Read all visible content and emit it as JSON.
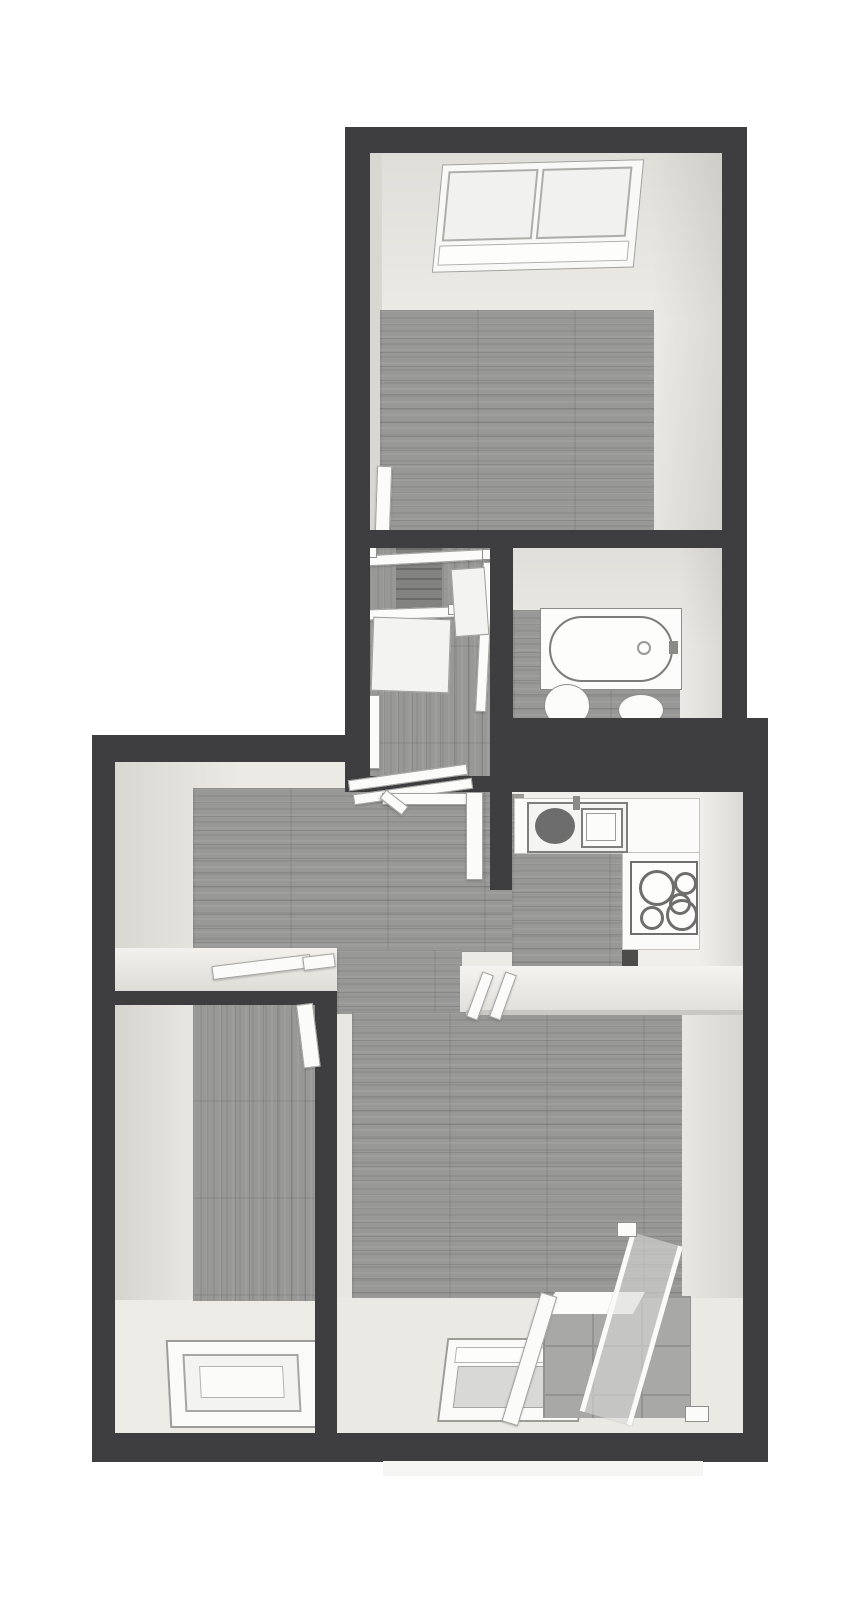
{
  "scene": {
    "type": "3d-floorplan-top-down",
    "description": "Monochrome 3D dollhouse-view floor plan of an attic apartment with sloped ceilings",
    "style": "grayscale render, dark walls, gray wood plank floors, white fixtures"
  },
  "colors": {
    "page-bg": "#ffffff",
    "wall": "#3e3e40",
    "wall-edge": "#4a4a4c",
    "face": "#e7e6e1",
    "face-bright": "#f2f1ed",
    "face-shade": "#d7d6d0",
    "wood": "#989896",
    "wood-dark": "#8a8a88",
    "wood-stair": "#828280",
    "white-fixture": "#fbfbfa",
    "fixture-line": "#8b8b88",
    "sink-dark": "#6d6d6d",
    "glass": "#d9dad8",
    "tile": "#a8a8a6",
    "tile-line": "#939391",
    "shadow": "#f5f5f4"
  },
  "rooms": [
    {
      "id": "room-top",
      "kind": "attic-bedroom",
      "floor": "wood",
      "features": [
        "skylight-window",
        "open-door-leaf"
      ]
    },
    {
      "id": "stair-landing",
      "kind": "staircase-landing",
      "floor": "wood",
      "features": [
        "stair-flight",
        "stair-railings",
        "entry-threshold"
      ]
    },
    {
      "id": "bathroom",
      "kind": "bathroom",
      "floor": "wood",
      "features": [
        "bathtub",
        "toilet",
        "washbasin"
      ]
    },
    {
      "id": "hallway",
      "kind": "hallway",
      "floor": "wood",
      "features": [
        "entry-door-frame",
        "door-thresholds"
      ]
    },
    {
      "id": "kitchen",
      "kind": "kitchen",
      "floor": "wood",
      "features": [
        "l-shaped-counter",
        "kitchen-sink",
        "drainboard",
        "cooktop"
      ]
    },
    {
      "id": "room-left",
      "kind": "attic-room",
      "floor": "wood",
      "features": [
        "roof-window",
        "open-door-leaf"
      ]
    },
    {
      "id": "room-main",
      "kind": "attic-living-room",
      "floor": "wood",
      "features": [
        "roof-window",
        "balcony-loggia",
        "glass-railing",
        "tiled-floor"
      ]
    }
  ],
  "fixtures": {
    "skylight": {
      "panes": 2
    },
    "bathtub": {
      "shape": "oval-in-rect",
      "faucet": "right"
    },
    "cooktop": {
      "burners": [
        {
          "l": 7,
          "t": 7,
          "d": 30
        },
        {
          "l": 42,
          "t": 9,
          "d": 17
        },
        {
          "l": 8,
          "t": 43,
          "d": 18
        },
        {
          "l": 34,
          "t": 36,
          "d": 26
        },
        {
          "l": 37,
          "t": 30,
          "d": 16
        }
      ]
    },
    "balcony": {
      "railing": "glass",
      "floor": "tile"
    }
  }
}
